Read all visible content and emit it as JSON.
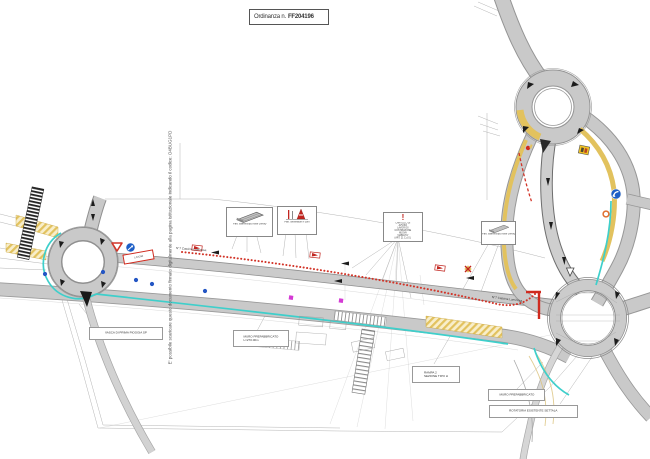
{
  "title_box": {
    "label": "Ordinanza n.",
    "number": "FF204196"
  },
  "watermark": {
    "text": "E' possibile scaricare questo documento firmato digitalmente alla pagina istituzionale indicando il codice: O4BUG1PD",
    "code": "O4BUG1PD"
  },
  "callouts": {
    "barrier_west": {
      "caption": "Part. barriera tipo New Jersey"
    },
    "cones": {
      "caption": "Part. delineatori e coni"
    },
    "warning": {
      "icon": "!",
      "lines": [
        "CARTELLO DI AVVISO",
        "LAVORI DI COSTRUZIONE",
        "NUOVA VIABILITA'",
        "(ART. 21 C.d.S.)"
      ]
    },
    "barrier_east": {
      "caption": "Part. barriera tipo New Jersey"
    }
  },
  "labels": {
    "vasca": "VASCA DI PRIMA PIOGGIA SP",
    "muro_west_1": "MURO PREFABBRICATO",
    "muro_west_2": "L=270.00m",
    "rampa_1": "RAMPA 2",
    "rampa_2": "SEZIONE TIPO H",
    "muro_east": "MURO PREFABBRICATO",
    "rotatoria": "ROTATORIA ESISTENTE SETTALA",
    "road_name_west": "N°7 Cascina Luminosa",
    "road_name_east": "N°7 Cascina Luminosa",
    "work_zone_sign": "LAVORI"
  },
  "icons": {
    "yield": "yield-triangle-sign",
    "keep_right": "blue-keep-right-sign",
    "turn_left": "blue-turn-sign",
    "roadworks": "yellow-roadworks-sign",
    "warning": "red-warning-icon"
  },
  "colors": {
    "road_fill": "#c9c9c9",
    "road_edge": "#8f8f8f",
    "lane_yellow": "#e2c25e",
    "survey_cyan": "#3ecfcb",
    "work_red": "#d23428",
    "sign_blue": "#1d5ec6",
    "marker_magenta": "#d43ad4",
    "dot_blue": "#2456c4"
  }
}
